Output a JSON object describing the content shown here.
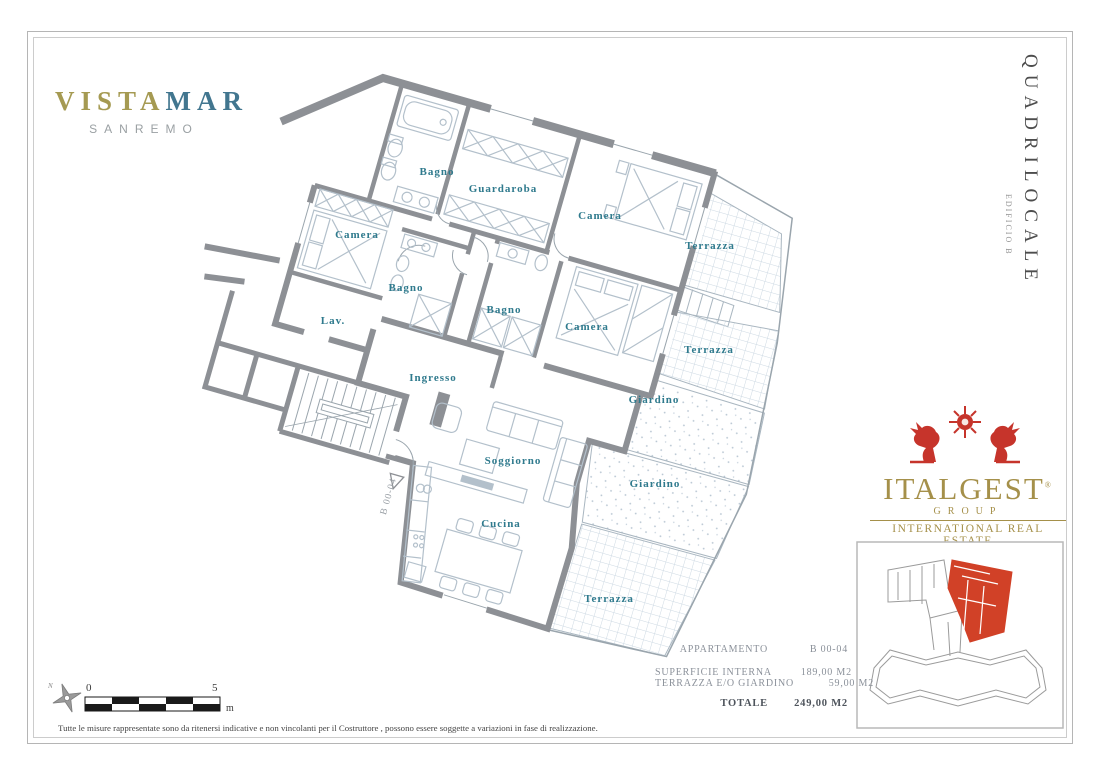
{
  "branding": {
    "name_part1": "VISTA",
    "name_part2": "MAR",
    "subtitle": "SANREMO"
  },
  "side_title": {
    "main": "QUADRILOCALE",
    "sub": "EDIFICIO B"
  },
  "agency": {
    "name": "ITALGEST",
    "registered": "®",
    "group": "GROUP",
    "tagline": "INTERNATIONAL REAL ESTATE"
  },
  "floorplan": {
    "unit_code": "B 00-04",
    "rooms": [
      "Bagno",
      "Guardaroba",
      "Camera",
      "Camera",
      "Bagno",
      "Lav.",
      "Bagno",
      "Camera",
      "Ingresso",
      "Soggiorno",
      "Cucina",
      "Terrazza",
      "Terrazza",
      "Giardino",
      "Giardino",
      "Terrazza"
    ]
  },
  "details": {
    "apartment_label": "APPARTAMENTO",
    "apartment_value": "B 00-04",
    "rows": [
      {
        "label": "SUPERFICIE INTERNA",
        "value": "189,00 M2"
      },
      {
        "label": "TERRAZZA E/O GIARDINO",
        "value": "59,00 M2"
      }
    ],
    "total_label": "TOTALE",
    "total_value": "249,00 M2"
  },
  "scalebar": {
    "zero": "0",
    "five": "5",
    "unit": "m"
  },
  "disclaimer": "Tutte le misure rappresentate sono da ritenersi indicative e non vincolanti per il Costruttore , possono essere soggette a variazioni in fase di realizzazione.",
  "colors": {
    "accent_teal": "#2f7a8d",
    "brand_gold": "#a6914b",
    "brand_teal": "#447e95",
    "highlight_red": "#cf3e28",
    "wall_gray": "#8d9095"
  }
}
